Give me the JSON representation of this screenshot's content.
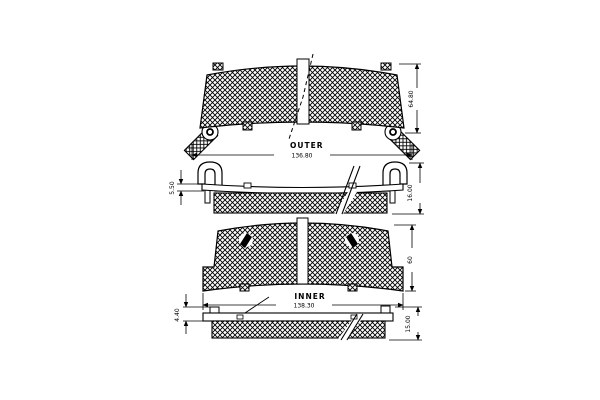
{
  "drawing": {
    "type": "technical-diagram",
    "subject": "disc-brake-pad-set",
    "views": {
      "outer_front": {
        "label": "OUTER",
        "width": "136.80",
        "height": "64.80"
      },
      "outer_side": {
        "backing_thickness": "5.50",
        "total_thickness": "16.00"
      },
      "inner_front": {
        "label": "INNER",
        "width": "138.30",
        "height": "60"
      },
      "inner_side": {
        "backing_thickness": "4.40",
        "total_thickness": "15.00"
      }
    },
    "colors": {
      "line": "#000000",
      "background": "#ffffff"
    }
  }
}
